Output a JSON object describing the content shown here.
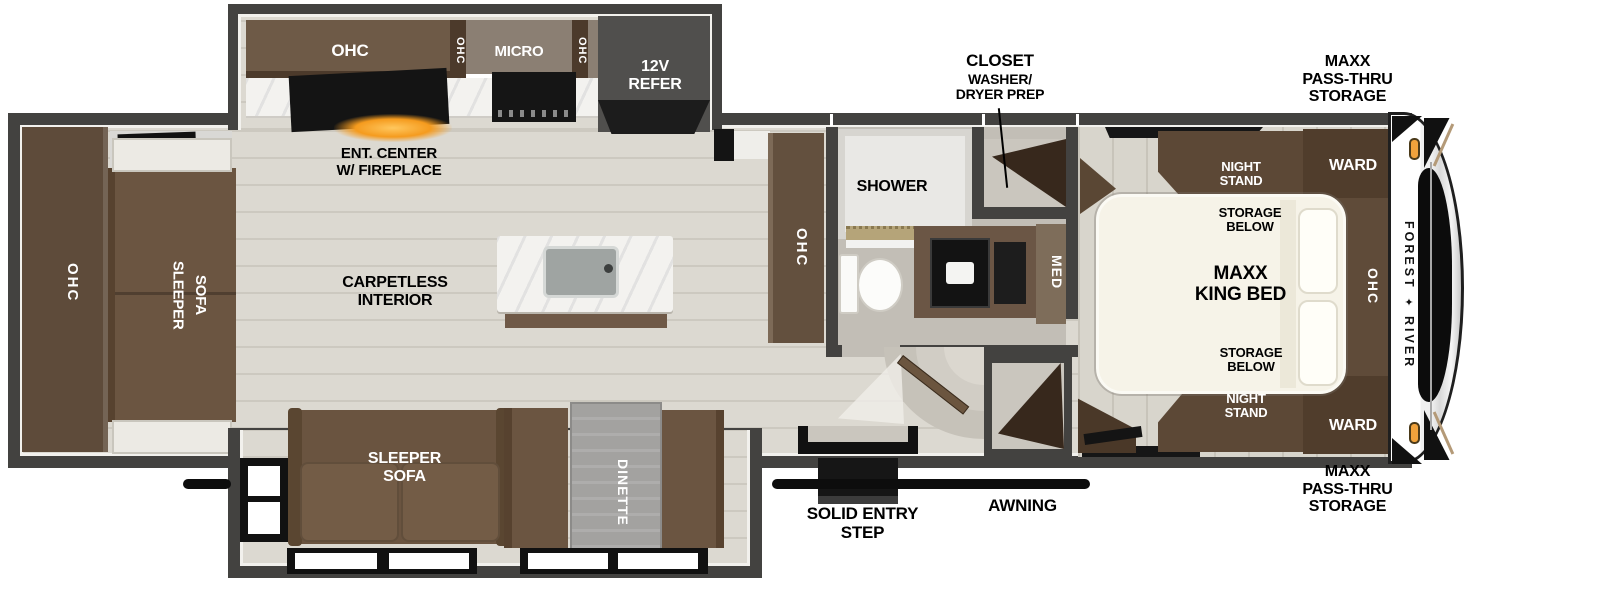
{
  "colors": {
    "wall": "#434240",
    "floor": "#dcd9d1",
    "bath_floor": "#c2beb6",
    "cabinet_brown": "#5e4b3a",
    "cabinet_dark": "#4c3a2b",
    "sofa_brown": "#6b5541",
    "counter_marble": "#f3f2ef",
    "refer_grey": "#504f4d",
    "bed_cream": "#f6f3e8",
    "fireplace_glow": "#f59b1e",
    "marker_light": "#f0a23c",
    "dinette_table": "#a3a2a0"
  },
  "kitchen_slide": {
    "ohc_label": "OHC",
    "ohc_divider_left": "OHC",
    "micro_label": "MICRO",
    "ohc_divider_right": "OHC",
    "refer_label": "12V\nREFER"
  },
  "living": {
    "ent_center_label": "ENT. CENTER\nW/ FIREPLACE",
    "carpetless_label": "CARPETLESS\nINTERIOR",
    "rear_ohc_label": "OHC",
    "rear_sofa_label": "SLEEPER\nSOFA",
    "pantry_ohc_label": "OHC"
  },
  "bathroom": {
    "shower_label": "SHOWER",
    "med_label": "MED",
    "closet_title": "CLOSET",
    "closet_subtitle": "WASHER/\nDRYER PREP"
  },
  "bedroom": {
    "night_stand_top_label": "NIGHT\nSTAND",
    "storage_below_top_label": "STORAGE\nBELOW",
    "bed_label": "MAXX\nKING BED",
    "storage_below_bottom_label": "STORAGE\nBELOW",
    "night_stand_bottom_label": "NIGHT\nSTAND",
    "ward_top_label": "WARD",
    "ward_bottom_label": "WARD",
    "ohc_label": "OHC"
  },
  "sofa_slide": {
    "sofa_label": "SLEEPER\nSOFA",
    "dinette_label": "DINETTE"
  },
  "exterior": {
    "pass_thru_top_label": "MAXX\nPASS-THRU\nSTORAGE",
    "pass_thru_bottom_label": "MAXX\nPASS-THRU\nSTORAGE",
    "entry_step_label": "SOLID ENTRY\nSTEP",
    "awning_label": "AWNING",
    "brand_word_1": "FOREST",
    "brand_word_2": "RIVER",
    "brand_crest_icon": "✦"
  }
}
